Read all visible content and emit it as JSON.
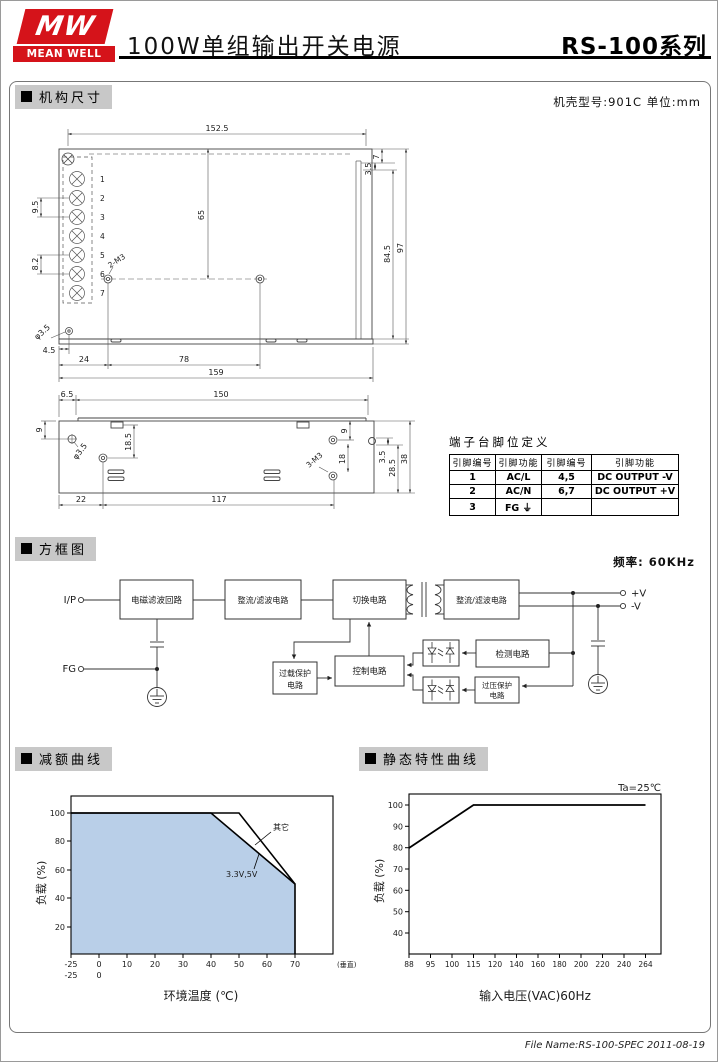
{
  "header": {
    "logo_mw": "MW",
    "logo_name": "MEAN WELL",
    "title": "100W单组输出开关电源",
    "series": "RS-100",
    "series_suffix": "系列"
  },
  "sections": {
    "mech": "机构尺寸",
    "block": "方框图",
    "derating": "减额曲线",
    "static": "静态特性曲线"
  },
  "mech": {
    "case_note": "机壳型号:901C 单位:mm",
    "top": {
      "w": "152.5",
      "lip": "7",
      "lip_off": "3.5",
      "h_inner": "84.5",
      "h_outer": "97",
      "pitch_a": "9.5",
      "pitch_b": "8.2",
      "depth": "65",
      "screws": "2-M3",
      "hole": "φ3.5",
      "hole_off": "4.5",
      "m3_off": "24",
      "m3_pitch": "78",
      "length": "159",
      "pins": [
        "1",
        "2",
        "3",
        "4",
        "5",
        "6",
        "7"
      ]
    },
    "side": {
      "end_off": "6.5",
      "length": "150",
      "hole_y": "9",
      "slot_y": "18.5",
      "hole": "φ3.5",
      "m3_off_x": "22",
      "m3_pitch_x": "117",
      "m3_y1": "9",
      "m3_y2": "18",
      "screws": "3-M3",
      "notch": "3.5",
      "h1": "28.5",
      "h2": "38"
    }
  },
  "pin_table": {
    "title": "端子台脚位定义",
    "headers": [
      "引脚编号",
      "引脚功能",
      "引脚编号",
      "引脚功能"
    ],
    "rows": [
      [
        "1",
        "AC/L",
        "4,5",
        "DC OUTPUT -V"
      ],
      [
        "2",
        "AC/N",
        "6,7",
        "DC OUTPUT +V"
      ],
      [
        "3",
        "FG ⏚",
        "",
        ""
      ]
    ]
  },
  "block": {
    "freq": "频率: 60KHz",
    "input": "I/P",
    "fg": "FG",
    "emi": "电磁滤波回路",
    "rectifier1": "整流/滤波电路",
    "switching": "切换电路",
    "rectifier2": "整流/滤波电路",
    "control": "控制电路",
    "overload1": "过载保护",
    "overload2": "电路",
    "detect": "检测电路",
    "ovp1": "过压保护",
    "ovp2": "电路",
    "out_pos": "+V",
    "out_neg": "-V"
  },
  "chart_data": [
    {
      "type": "area",
      "title": "减额曲线",
      "xlabel": "环境温度 (℃)",
      "ylabel": "负载 (%)",
      "x_ticks": [
        "-25",
        "0",
        "10",
        "20",
        "30",
        "40",
        "50",
        "60",
        "70"
      ],
      "x_ticks_row2": [
        "-25",
        "0"
      ],
      "x_note": "(垂直)",
      "y_ticks": [
        "100",
        "80",
        "60",
        "40",
        "20"
      ],
      "ylim": [
        0,
        105
      ],
      "grid": false,
      "fill_color": "#b9cfe8",
      "series": [
        {
          "name": "3.3V,5V",
          "points": [
            [
              -25,
              100
            ],
            [
              40,
              100
            ],
            [
              70,
              50
            ],
            [
              70,
              0
            ]
          ]
        },
        {
          "name": "其它",
          "points": [
            [
              -25,
              100
            ],
            [
              50,
              100
            ],
            [
              70,
              50
            ]
          ]
        }
      ]
    },
    {
      "type": "line",
      "title": "静态特性曲线",
      "annotation": "Ta=25℃",
      "xlabel": "输入电压(VAC)60Hz",
      "ylabel": "负载 (%)",
      "x_ticks": [
        "88",
        "95",
        "100",
        "115",
        "120",
        "140",
        "160",
        "180",
        "200",
        "220",
        "240",
        "264"
      ],
      "y_ticks": [
        "100",
        "90",
        "80",
        "70",
        "60",
        "50",
        "40"
      ],
      "ylim": [
        30,
        105
      ],
      "grid": false,
      "series": [
        {
          "name": "负载",
          "points": [
            [
              88,
              80
            ],
            [
              115,
              100
            ],
            [
              264,
              100
            ]
          ]
        }
      ]
    }
  ],
  "footer": {
    "file_info": "File Name:RS-100-SPEC  2011-08-19"
  }
}
